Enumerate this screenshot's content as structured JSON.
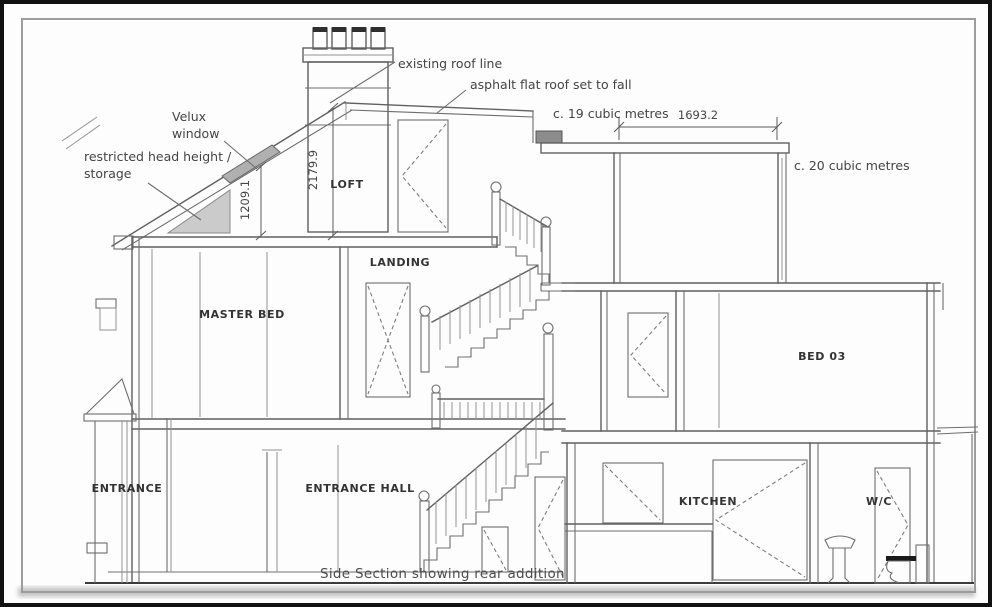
{
  "drawing": {
    "caption": "Side Section  showing rear addition",
    "rooms": {
      "loft": "LOFT",
      "landing": "LANDING",
      "master_bed": "MASTER BED",
      "entrance": "ENTRANCE",
      "entrance_hall": "ENTRANCE HALL",
      "kitchen": "KITCHEN",
      "wc": "W/C",
      "bed3": "BED 03"
    },
    "annotations": {
      "existing_roof": "existing roof line",
      "asphalt_roof": "asphalt flat roof set to fall",
      "velux_line1": "Velux",
      "velux_line2": "window",
      "restricted_line1": "restricted head height /",
      "restricted_line2": "storage",
      "vol19": "c. 19 cubic metres",
      "vol20": "c. 20 cubic metres"
    },
    "dimensions": {
      "flat_roof_width": "1693.2",
      "loft_height": "2179.9",
      "restricted_height": "1209.1"
    },
    "colors": {
      "line": "#606060",
      "text": "#3f3f3f",
      "shade": "#cbcbcb",
      "velux": "#b0b0b0",
      "border": "#111111"
    }
  }
}
